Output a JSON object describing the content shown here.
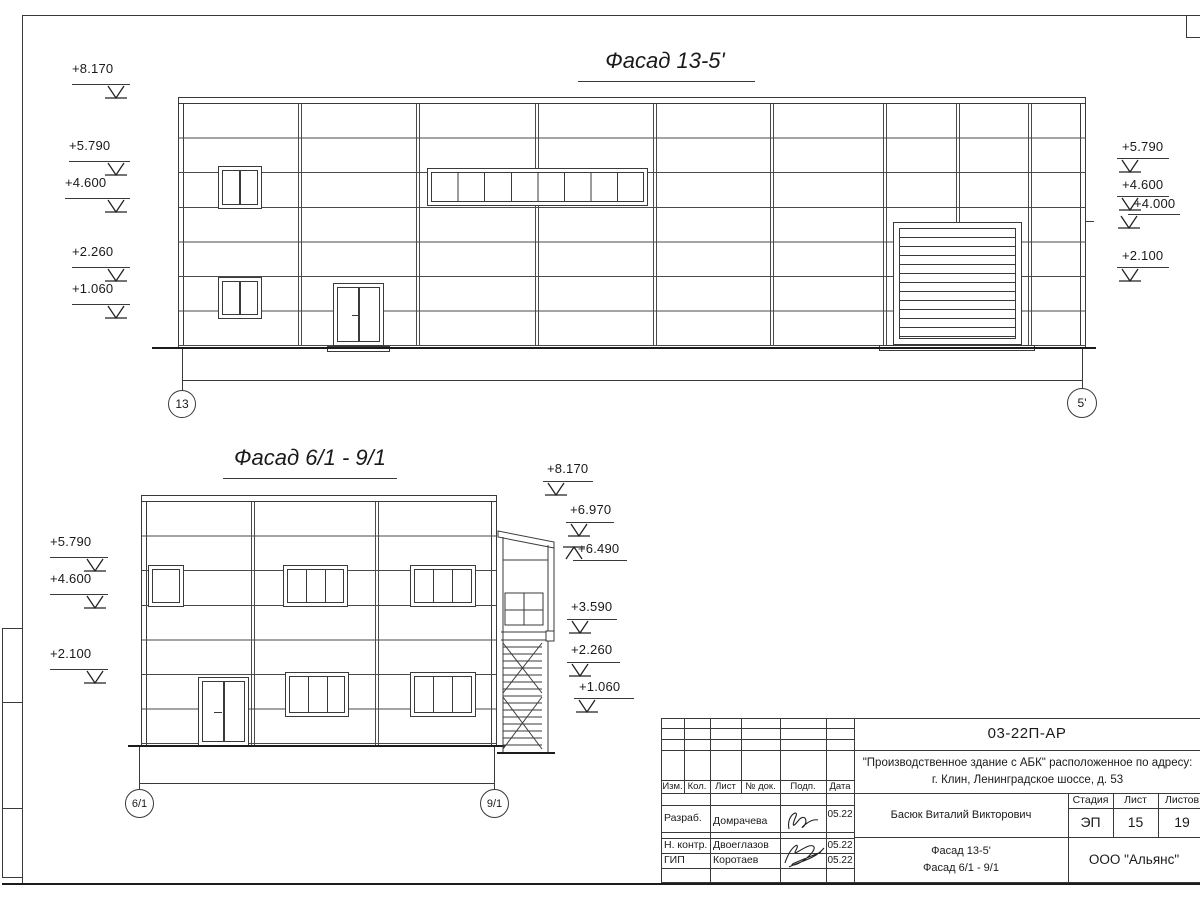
{
  "facade1": {
    "title": "Фасад 13-5'",
    "grid_left": "13",
    "grid_right": "5'",
    "marks_left": [
      "+8.170",
      "+5.790",
      "+4.600",
      "+2.260",
      "+1.060"
    ],
    "marks_right": [
      "+5.790",
      "+4.600",
      "+4.000",
      "+2.100"
    ]
  },
  "facade2": {
    "title": "Фасад 6/1 - 9/1",
    "grid_left": "6/1",
    "grid_right": "9/1",
    "marks_left": [
      "+5.790",
      "+4.600",
      "+2.100"
    ],
    "marks_right": [
      "+8.170",
      "+6.970",
      "+6.490",
      "+3.590",
      "+2.260",
      "+1.060"
    ]
  },
  "titleblock": {
    "doc_number": "03-22П-АР",
    "project_line1": "\"Производственное здание с АБК\" расположенное по адресу:",
    "project_line2": "г. Клин, Ленинградское шоссе, д. 53",
    "header_cols": [
      "Изм.",
      "Кол.",
      "Лист",
      "№ док.",
      "Подп.",
      "Дата"
    ],
    "rows": [
      {
        "role": "Разраб.",
        "name": "Домрачева",
        "date": "05.22"
      },
      {
        "role": "Н. контр.",
        "name": "Двоеглазов",
        "date": "05.22"
      },
      {
        "role": "ГИП",
        "name": "Коротаев",
        "date": "05.22"
      }
    ],
    "chief": "Басюк Виталий Викторович",
    "stage_label": "Стадия",
    "sheet_label": "Лист",
    "sheets_label": "Листов",
    "stage": "ЭП",
    "sheet_no": "15",
    "sheets_total": "19",
    "drawing_title_line1": "Фасад 13-5'",
    "drawing_title_line2": "Фасад 6/1 - 9/1",
    "company": "ООО \"Альянс\""
  }
}
